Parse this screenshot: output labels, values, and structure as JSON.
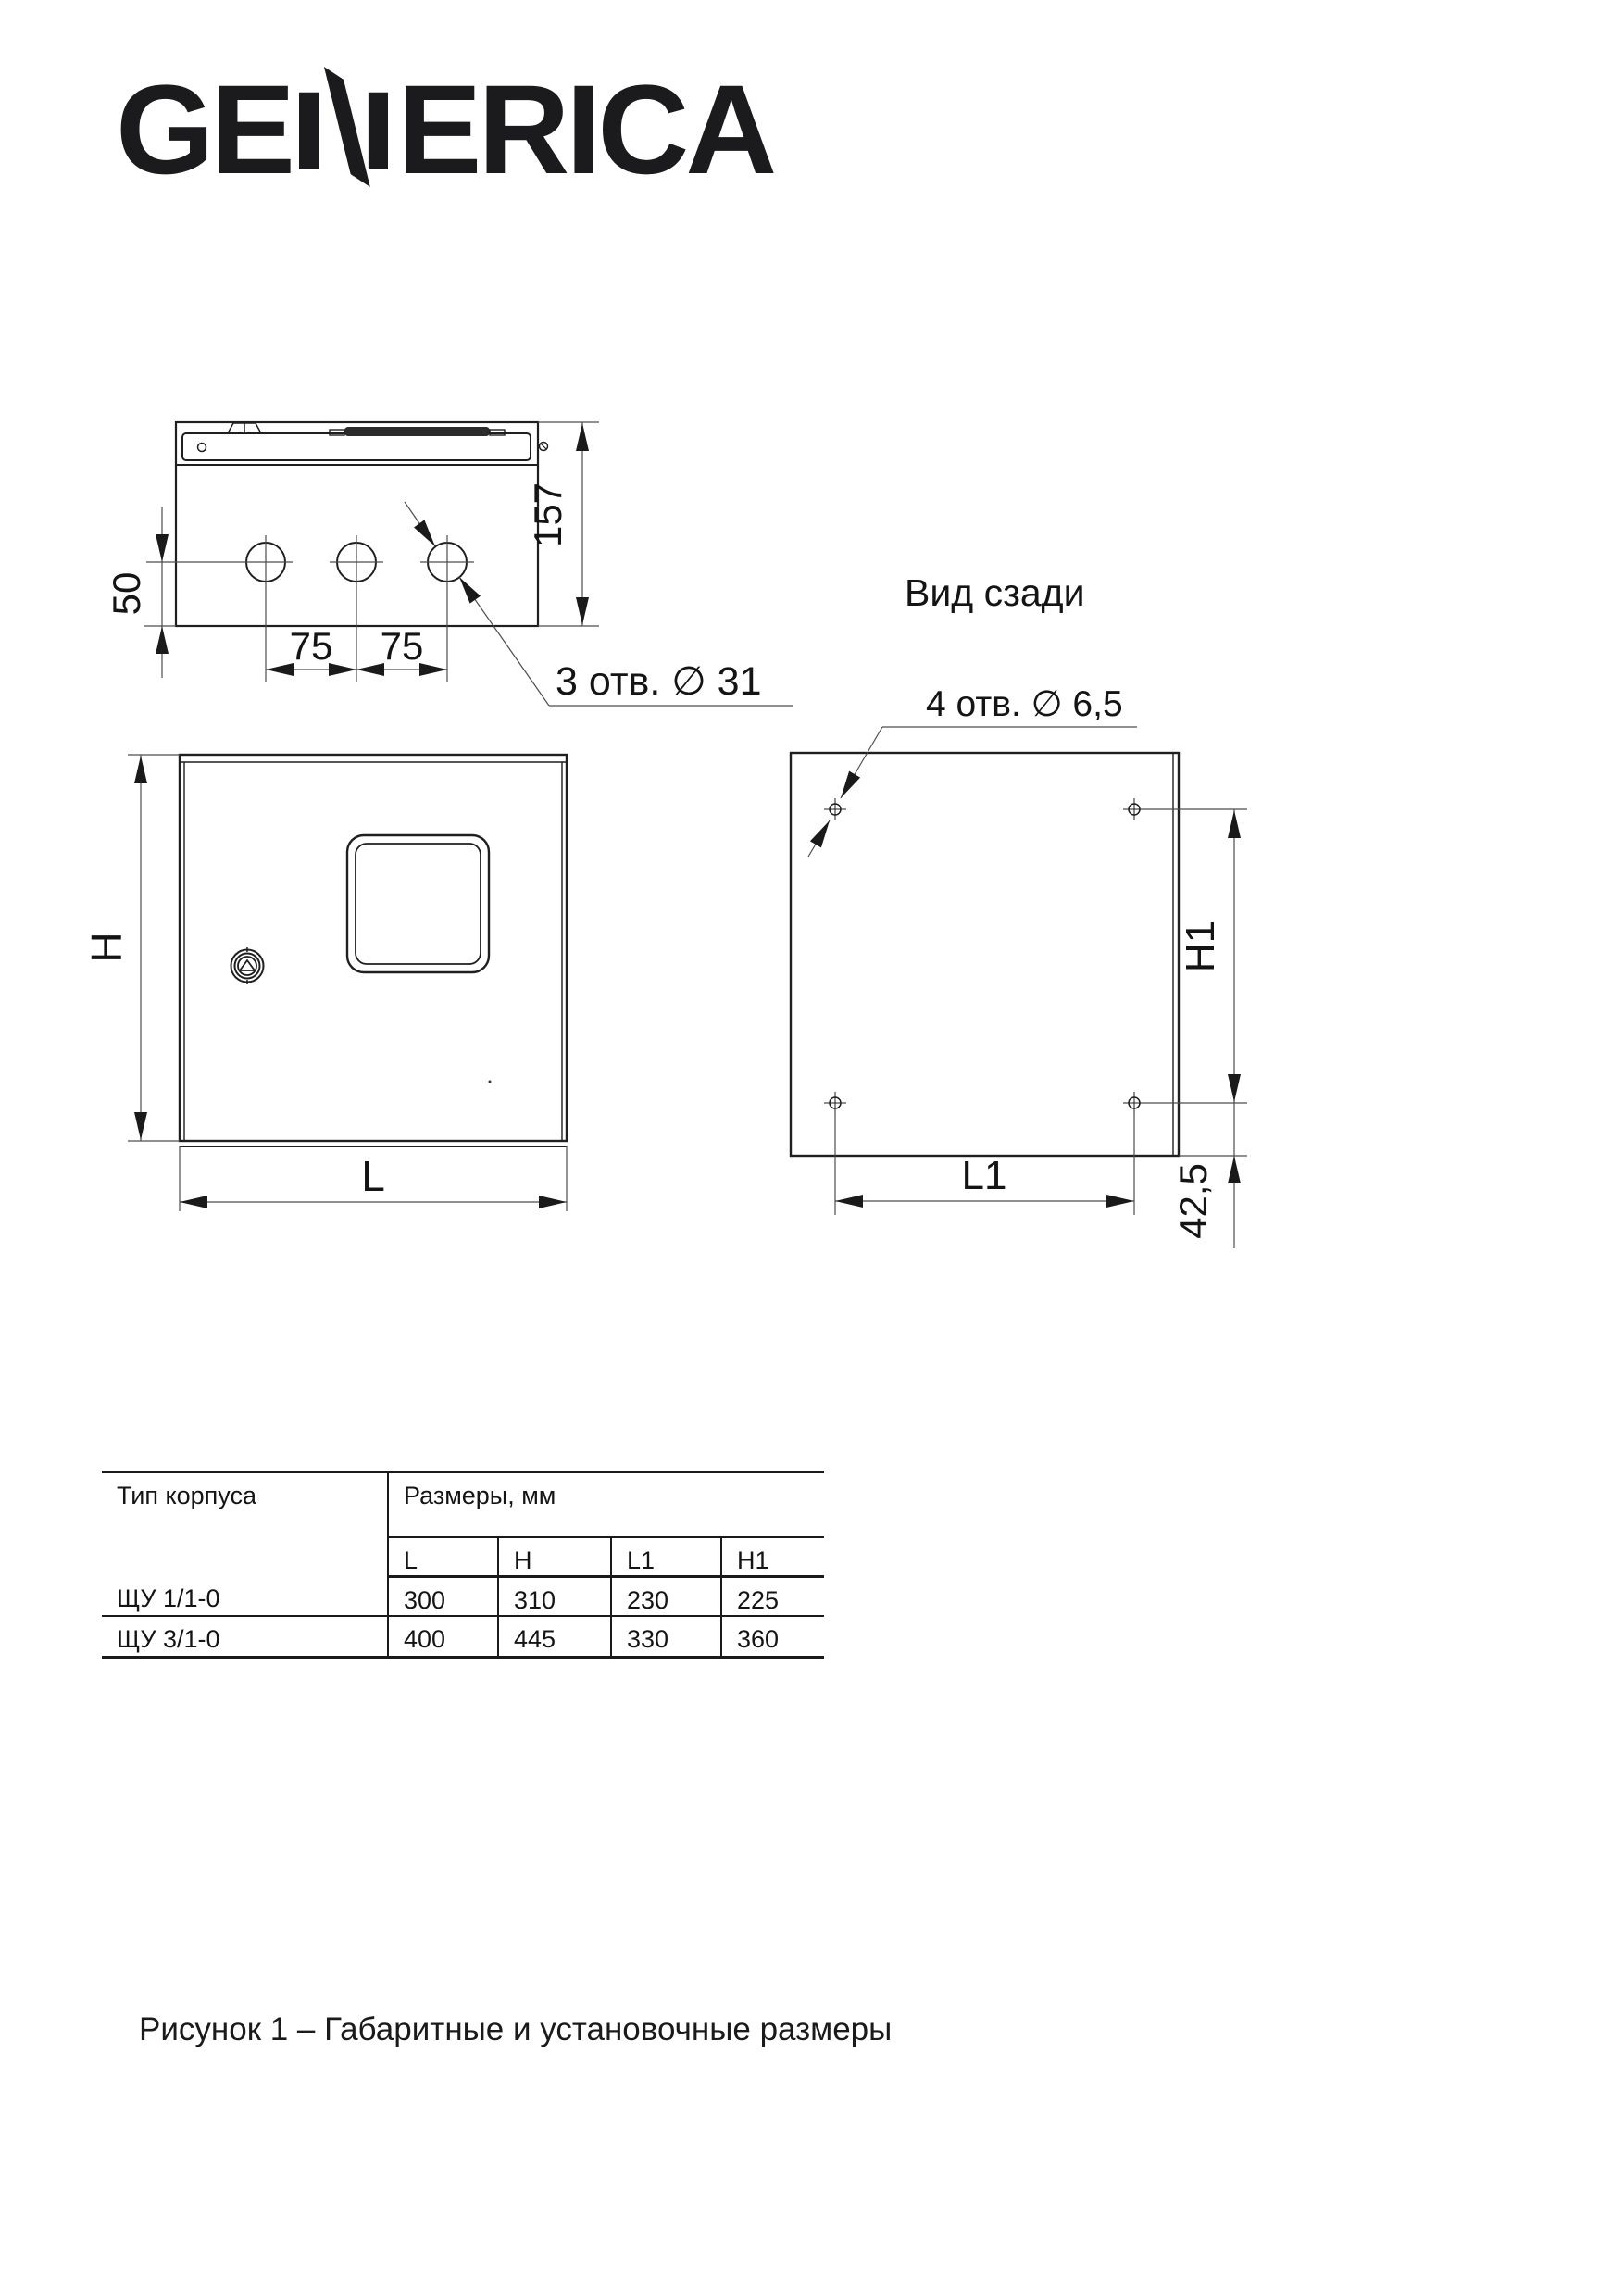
{
  "logo": {
    "left": "GE",
    "right": "ERICA"
  },
  "views": {
    "top": {
      "dim_depth": "157",
      "dim_hole_offset": "50",
      "spacing": [
        "75",
        "75"
      ],
      "holes_note": "3 отв. ∅ 31"
    },
    "front": {
      "dim_height": "H",
      "dim_width": "L"
    },
    "rear": {
      "title": "Вид сзади",
      "holes_note": "4 отв. ∅ 6,5",
      "dim_height": "H1",
      "dim_width": "L1",
      "dim_bottom_offset": "42,5"
    }
  },
  "table": {
    "col1_header": "Тип корпуса",
    "group_header": "Размеры, мм",
    "columns": [
      "L",
      "H",
      "L1",
      "H1"
    ],
    "rows": [
      {
        "type": "ЩУ 1/1-0",
        "values": [
          "300",
          "310",
          "230",
          "225"
        ]
      },
      {
        "type": "ЩУ 3/1-0",
        "values": [
          "400",
          "445",
          "330",
          "360"
        ]
      }
    ]
  },
  "caption": "Рисунок 1 – Габаритные и установочные размеры",
  "colors": {
    "contour": "#1f1f1f",
    "dimension_line": "#4d4d4d",
    "text": "#141414",
    "background": "#ffffff"
  }
}
